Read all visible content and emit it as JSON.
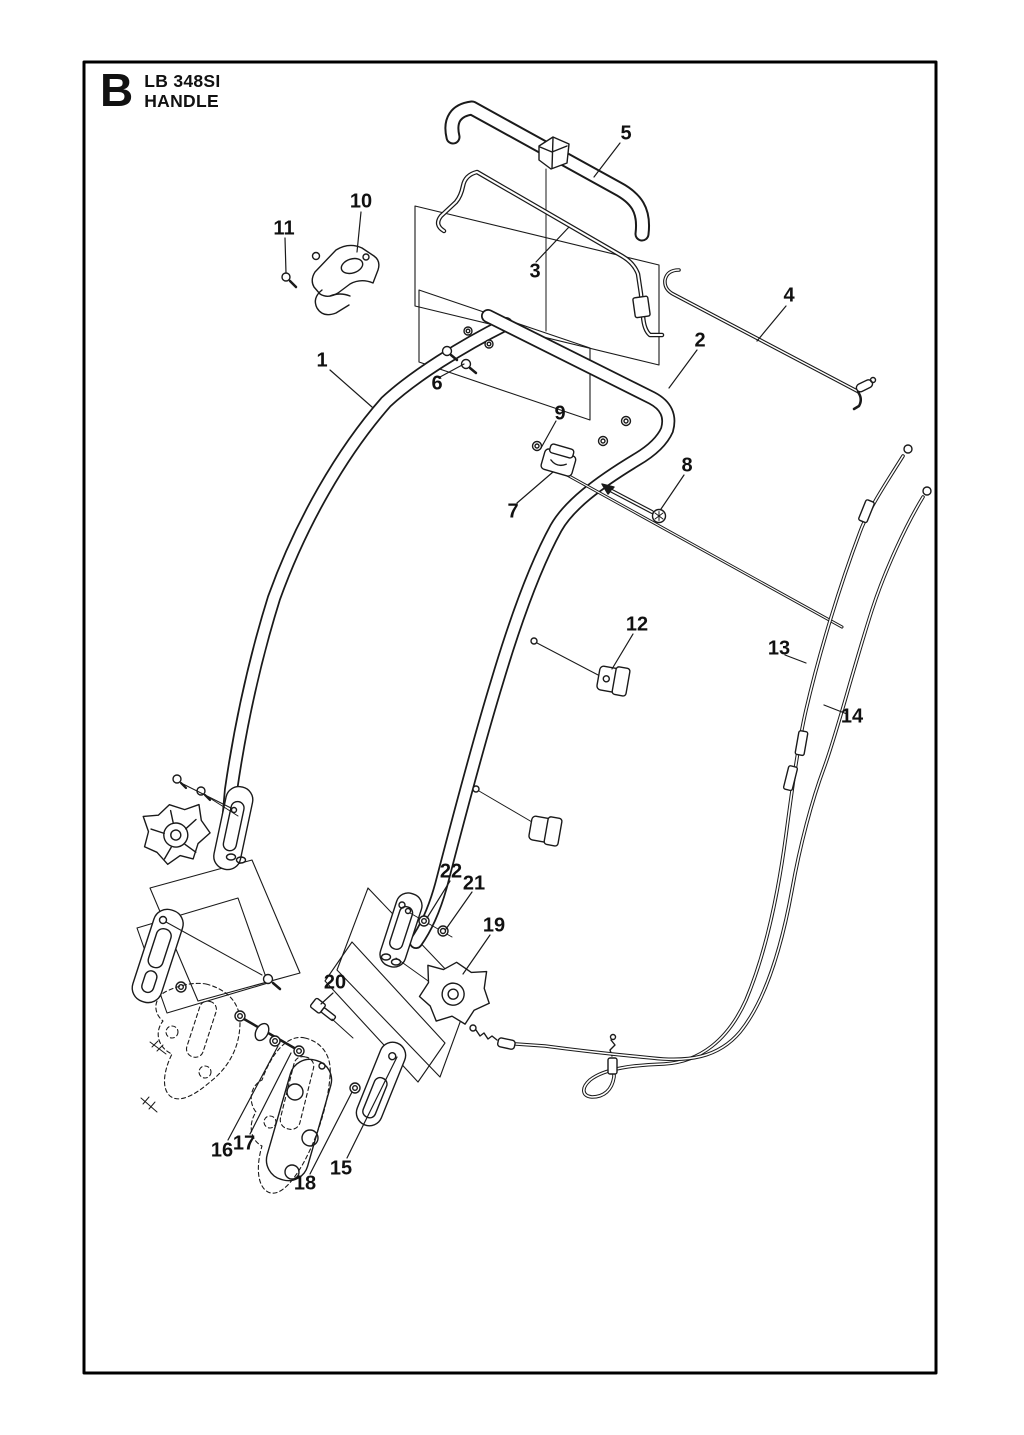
{
  "title_block": {
    "section_letter": "B",
    "model": "LB 348SI",
    "section_name": "HANDLE"
  },
  "colors": {
    "line": "#1a1a1a",
    "background": "#ffffff"
  },
  "parts": [
    {
      "number": "1"
    },
    {
      "number": "2"
    },
    {
      "number": "3"
    },
    {
      "number": "4"
    },
    {
      "number": "5"
    },
    {
      "number": "6"
    },
    {
      "number": "7"
    },
    {
      "number": "8"
    },
    {
      "number": "9"
    },
    {
      "number": "10"
    },
    {
      "number": "11"
    },
    {
      "number": "12"
    },
    {
      "number": "13"
    },
    {
      "number": "14"
    },
    {
      "number": "15"
    },
    {
      "number": "16"
    },
    {
      "number": "17"
    },
    {
      "number": "18"
    },
    {
      "number": "19"
    },
    {
      "number": "20"
    },
    {
      "number": "21"
    },
    {
      "number": "22"
    }
  ]
}
